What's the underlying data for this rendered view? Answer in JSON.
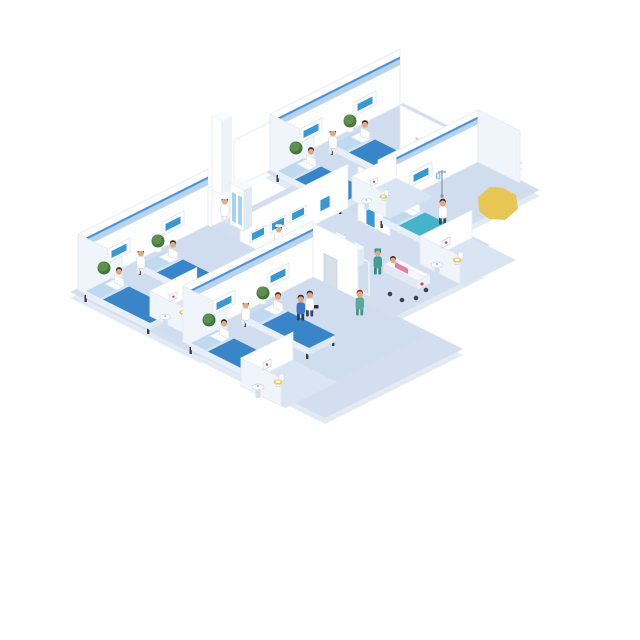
{
  "scene": {
    "alt": "Isometric hospital ward illustration: four patient rooms with blue beds, four bathrooms, central reception desk with wall monitors, two self-service kiosks behind a glass partition, medical staff, patients and a surgeon pushing a gurney; yellow highlight shape at upper right",
    "background": "#ffffff"
  },
  "colors": {
    "floor": "#d3dff0",
    "floor_ward": "#cfddef",
    "floor_bath": "#dae5f3",
    "wall": "#ffffff",
    "wall_end": "#f0f4fb",
    "stripe_dark": "#4d94d8",
    "stripe_light": "#b8d3ee",
    "bed_blue": "#3886c9",
    "bed_teal": "#43b4c9",
    "mattress_light": "#bfd9ef",
    "screen_blue": "#3598d8",
    "desk_blue": "#2e62ae",
    "desk_blue_dark": "#24509a",
    "desk_band": "#5c8cc9",
    "plant_green": "#5d9150",
    "plant_green_dark": "#46773c",
    "scrubs_green": "#3f9f92",
    "nurse_green": "#5aa99b",
    "skin": "#e5a87c",
    "hair": "#30302f",
    "seat_yellow": "#ecc94b",
    "highlight_yellow": "#e8c654",
    "door_gray": "#d9dfe9",
    "glass": "#cfe0f1",
    "patient_pink": "#e77fa0",
    "shirt_orange": "#e08a2e",
    "uniform_blue": "#3c76c4",
    "cross_red": "#d14a3a"
  },
  "inventory": {
    "patient_rooms": 4,
    "beds": 7,
    "bathrooms": 4,
    "reception_monitors": 3,
    "self_service_kiosks": 2,
    "plants": 7,
    "gurneys": 1,
    "wall_posters": 2,
    "doors": 3
  },
  "people": {
    "receptionist": 1,
    "ward_nurses": 3,
    "cabinet_nurse": 1,
    "doctor_at_bedside": 1,
    "staff_walking": 2,
    "nurse_green_walking": 1,
    "surgeon_with_gurney": 1,
    "patients_in_bed": 7,
    "patient_on_gurney": 1,
    "kiosk_users": 2
  }
}
